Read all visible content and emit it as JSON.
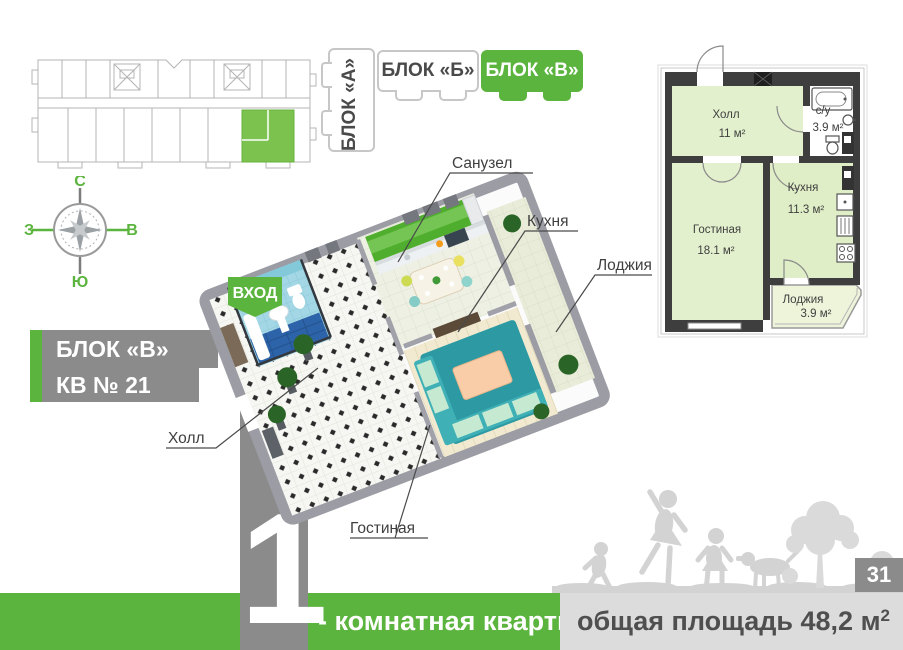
{
  "colors": {
    "accent_green": "#5bb43d",
    "badge_gray": "#8b8b8b",
    "footer_gray_bar": "#dcdcdc",
    "silhouette_gray": "#d3d3d3",
    "plan_room_fill": "#e3f0cd",
    "plan_loggia_fill": "#eef4da",
    "plan_wall_dark": "#3e3e3e",
    "render_wall_gray": "#9b9ca4",
    "render_rug_teal": "#2c99a3",
    "render_cabinet_green": "#4fae2d",
    "label_text": "#3f3f3f"
  },
  "compass": {
    "north": "С",
    "south": "Ю",
    "west": "З",
    "east": "В"
  },
  "tabs": {
    "a": "БЛОК «А»",
    "b": "БЛОК «Б»",
    "v": "БЛОК «В»"
  },
  "badges": {
    "block": "БЛОК «В»",
    "apartment": "КВ № 21"
  },
  "render": {
    "entrance": "ВХОД",
    "labels": {
      "bathroom": "Санузел",
      "kitchen": "Кухня",
      "loggia": "Лоджия",
      "hall": "Холл",
      "living": "Гостиная"
    }
  },
  "plan": {
    "rooms": {
      "hall": {
        "name": "Холл",
        "area": "11 м²"
      },
      "wc": {
        "name": "с/у",
        "area": "3.9 м²"
      },
      "living": {
        "name": "Гостиная",
        "area": "18.1 м²"
      },
      "kitchen": {
        "name": "Кухня",
        "area": "11.3 м²"
      },
      "loggia": {
        "name": "Лоджия",
        "area": "3.9 м²"
      }
    }
  },
  "footer": {
    "rooms_count": "1",
    "type_label": "- комнатная квартира",
    "area_label": "общая площадь 48,2 м",
    "area_sup": "2",
    "page": "31"
  }
}
